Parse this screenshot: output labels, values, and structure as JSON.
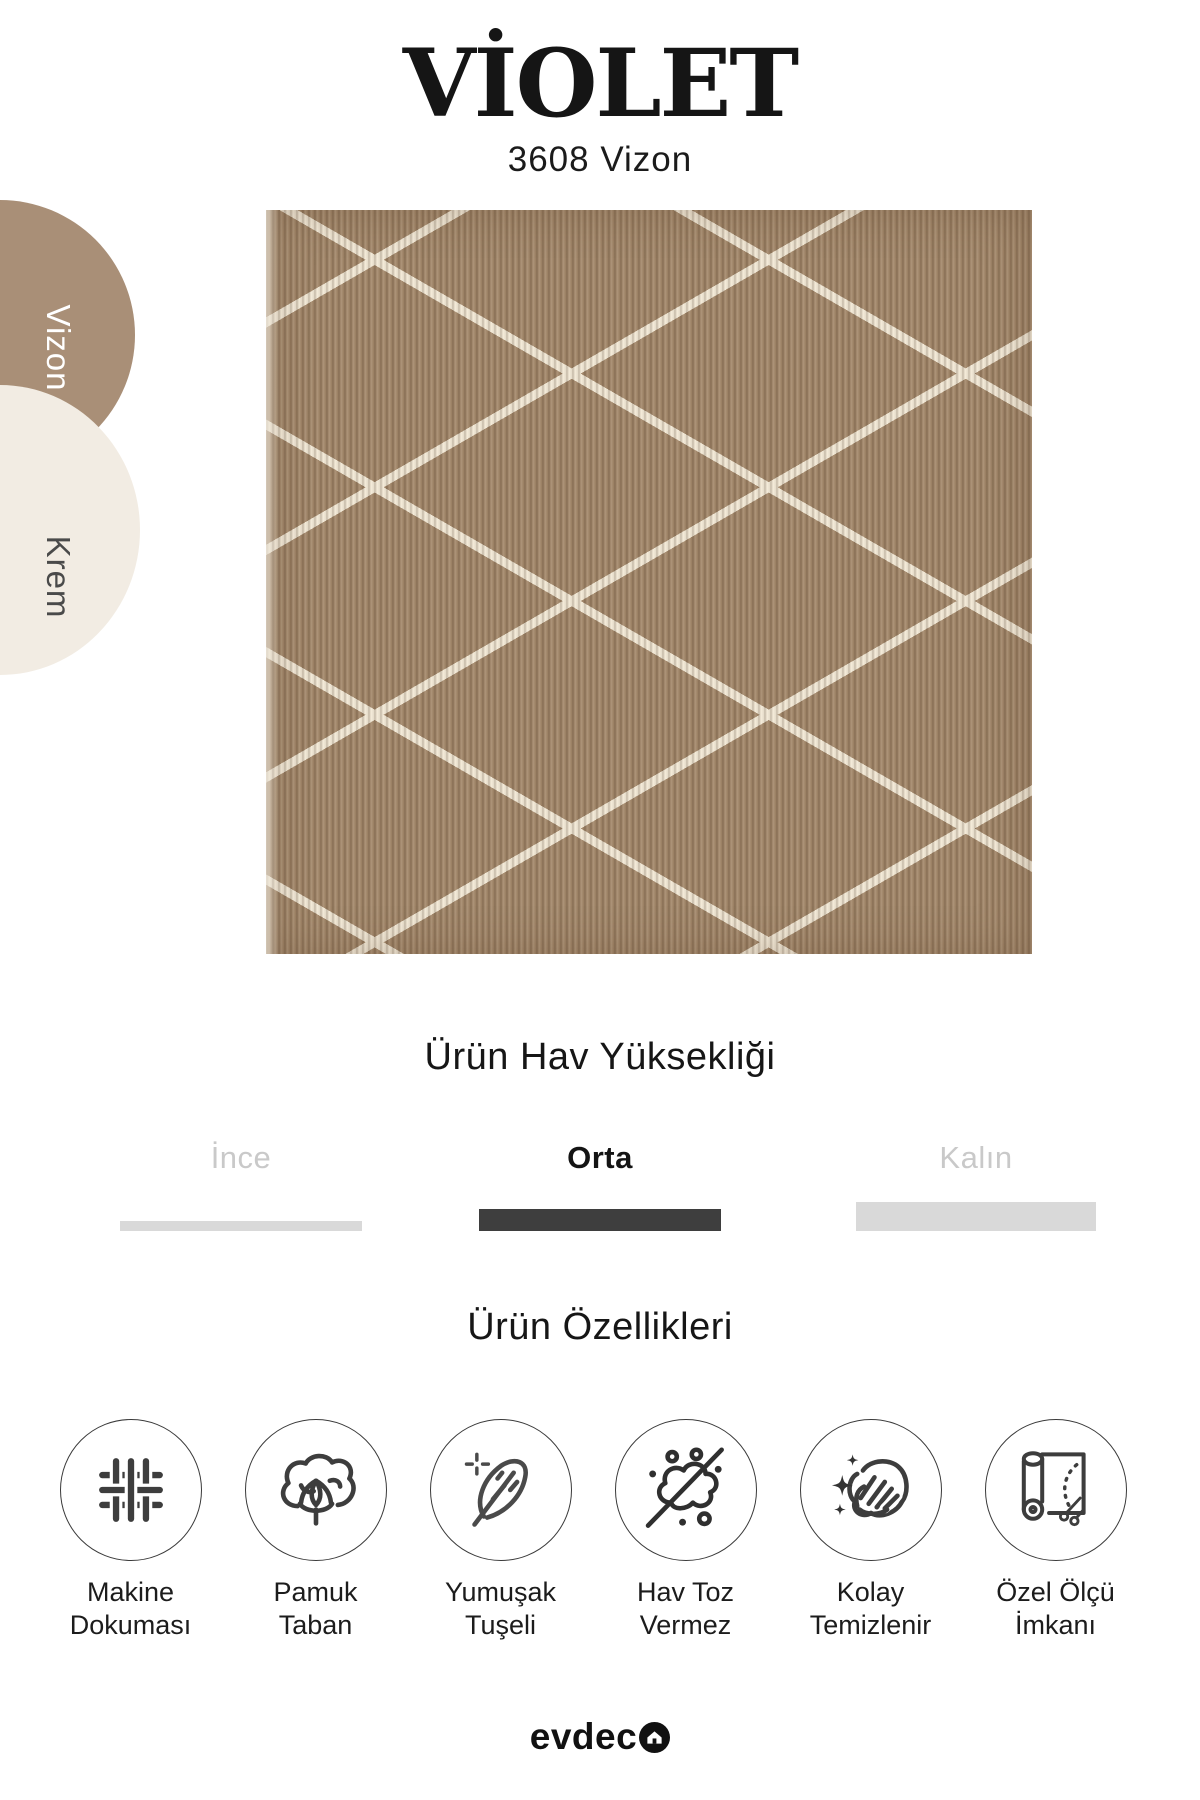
{
  "header": {
    "title": "VİOLET",
    "variant": "3608 Vizon"
  },
  "color_options": [
    {
      "name": "Vizon",
      "swatch_color": "#a98f77",
      "label_color": "#ffffff",
      "selected": true
    },
    {
      "name": "Krem",
      "swatch_color": "#f2ece3",
      "label_color": "#4a4a4a",
      "selected": false
    }
  ],
  "rug": {
    "pattern": "diamond-lattice",
    "base_color": "#a2876a",
    "rib_color": "#8f7557",
    "pattern_line_color": "#f2e9d7"
  },
  "pile_height": {
    "title": "Ürün Hav Yüksekliği",
    "selected_bar_color": "#3e3e3e",
    "unselected_bar_color": "#d9d9d9",
    "unselected_label_color": "#c9c9c9",
    "options": [
      {
        "label": "İnce",
        "selected": false
      },
      {
        "label": "Orta",
        "selected": true
      },
      {
        "label": "Kalın",
        "selected": false
      }
    ]
  },
  "features": {
    "title": "Ürün Özellikleri",
    "items": [
      {
        "icon": "weave-icon",
        "line1": "Makine",
        "line2": "Dokuması"
      },
      {
        "icon": "cotton-icon",
        "line1": "Pamuk",
        "line2": "Taban"
      },
      {
        "icon": "feather-icon",
        "line1": "Yumuşak",
        "line2": "Tuşeli"
      },
      {
        "icon": "dust-free-icon",
        "line1": "Hav Toz",
        "line2": "Vermez"
      },
      {
        "icon": "easy-clean-icon",
        "line1": "Kolay",
        "line2": "Temizlenir"
      },
      {
        "icon": "custom-size-icon",
        "line1": "Özel Ölçü",
        "line2": "İmkanı"
      }
    ]
  },
  "footer": {
    "brand": "evdeco",
    "brand_text": "evdec"
  }
}
